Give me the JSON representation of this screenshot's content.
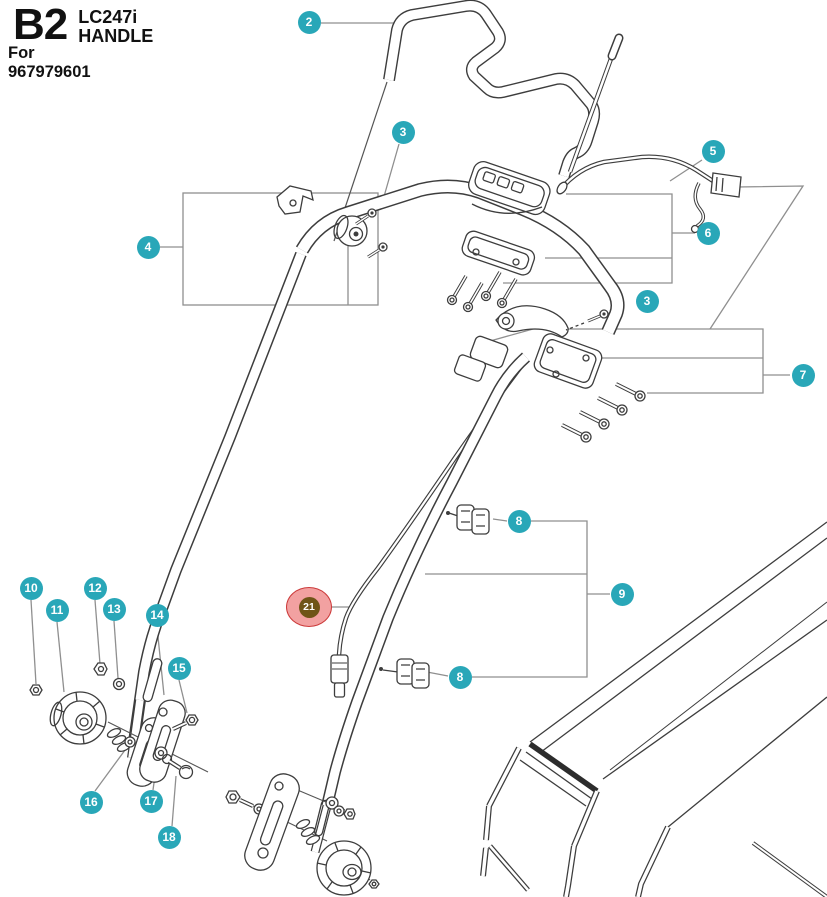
{
  "title": {
    "code": "B2",
    "model": "LC247i",
    "name": "HANDLE",
    "for_label": "For 967979601"
  },
  "colors": {
    "balloon_fill": "#29a7b8",
    "balloon_text": "#ffffff",
    "highlight_fill": "#f2a1a1",
    "highlight_border": "#cc3b3b",
    "highlight_inner_fill": "#6f5417",
    "art_line": "#3d3d3d",
    "callout_line": "#8f8f8f"
  },
  "balloons": [
    {
      "n": "2",
      "x": 309,
      "y": 22
    },
    {
      "n": "3",
      "x": 403,
      "y": 132
    },
    {
      "n": "4",
      "x": 148,
      "y": 247
    },
    {
      "n": "5",
      "x": 713,
      "y": 151
    },
    {
      "n": "6",
      "x": 708,
      "y": 233
    },
    {
      "n": "3",
      "x": 647,
      "y": 301
    },
    {
      "n": "7",
      "x": 803,
      "y": 375
    },
    {
      "n": "8",
      "x": 519,
      "y": 521
    },
    {
      "n": "9",
      "x": 622,
      "y": 594
    },
    {
      "n": "8",
      "x": 460,
      "y": 677
    },
    {
      "n": "10",
      "x": 31,
      "y": 588
    },
    {
      "n": "11",
      "x": 57,
      "y": 610
    },
    {
      "n": "12",
      "x": 95,
      "y": 588
    },
    {
      "n": "13",
      "x": 114,
      "y": 609
    },
    {
      "n": "14",
      "x": 157,
      "y": 615
    },
    {
      "n": "15",
      "x": 179,
      "y": 668
    },
    {
      "n": "16",
      "x": 91,
      "y": 802
    },
    {
      "n": "17",
      "x": 151,
      "y": 801
    },
    {
      "n": "18",
      "x": 169,
      "y": 837
    },
    {
      "n": "21",
      "x": 309,
      "y": 607,
      "highlighted": true
    }
  ]
}
